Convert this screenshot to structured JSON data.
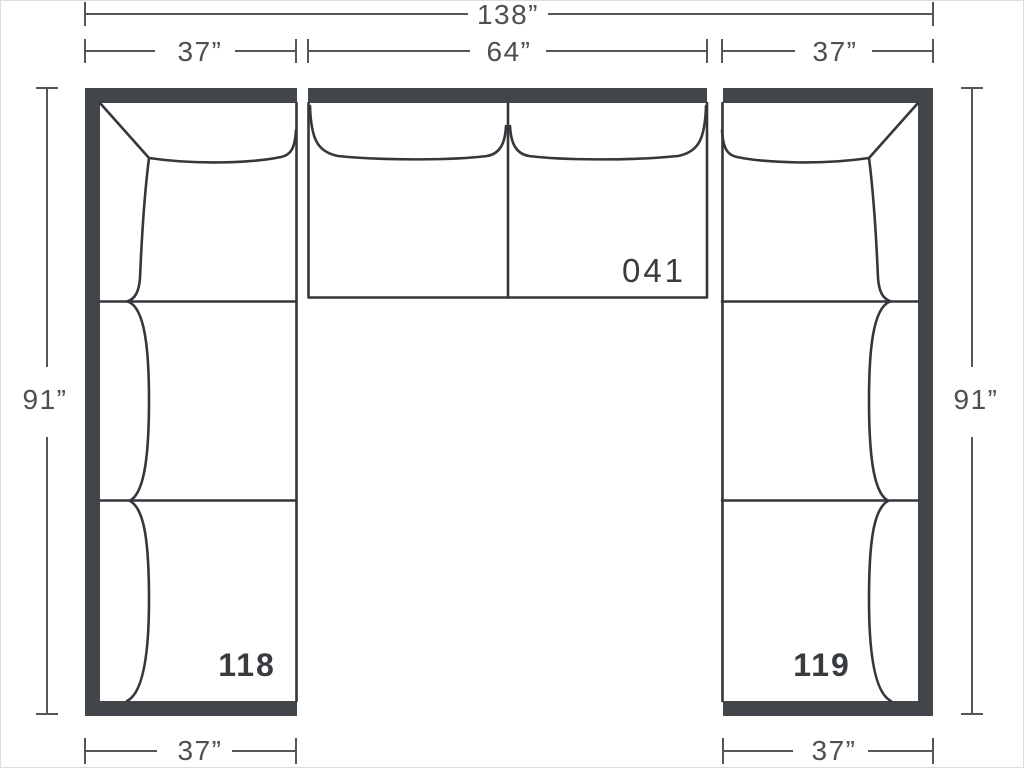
{
  "diagram_type": "sectional-sofa-floorplan",
  "dimensions": {
    "overall_width": "138”",
    "top_left": "37”",
    "top_center": "64”",
    "top_right": "37”",
    "side_left": "91”",
    "side_right": "91”",
    "bottom_left": "37”",
    "bottom_right": "37”"
  },
  "pieces": {
    "center_label": "041",
    "left_label": "118",
    "right_label": "119"
  },
  "colors": {
    "background": "#ffffff",
    "back_bar": "#42464a",
    "outline": "#34373b",
    "dimension_line": "#53575b",
    "dimension_text": "#4c5054",
    "piece_label": "#383c40"
  }
}
